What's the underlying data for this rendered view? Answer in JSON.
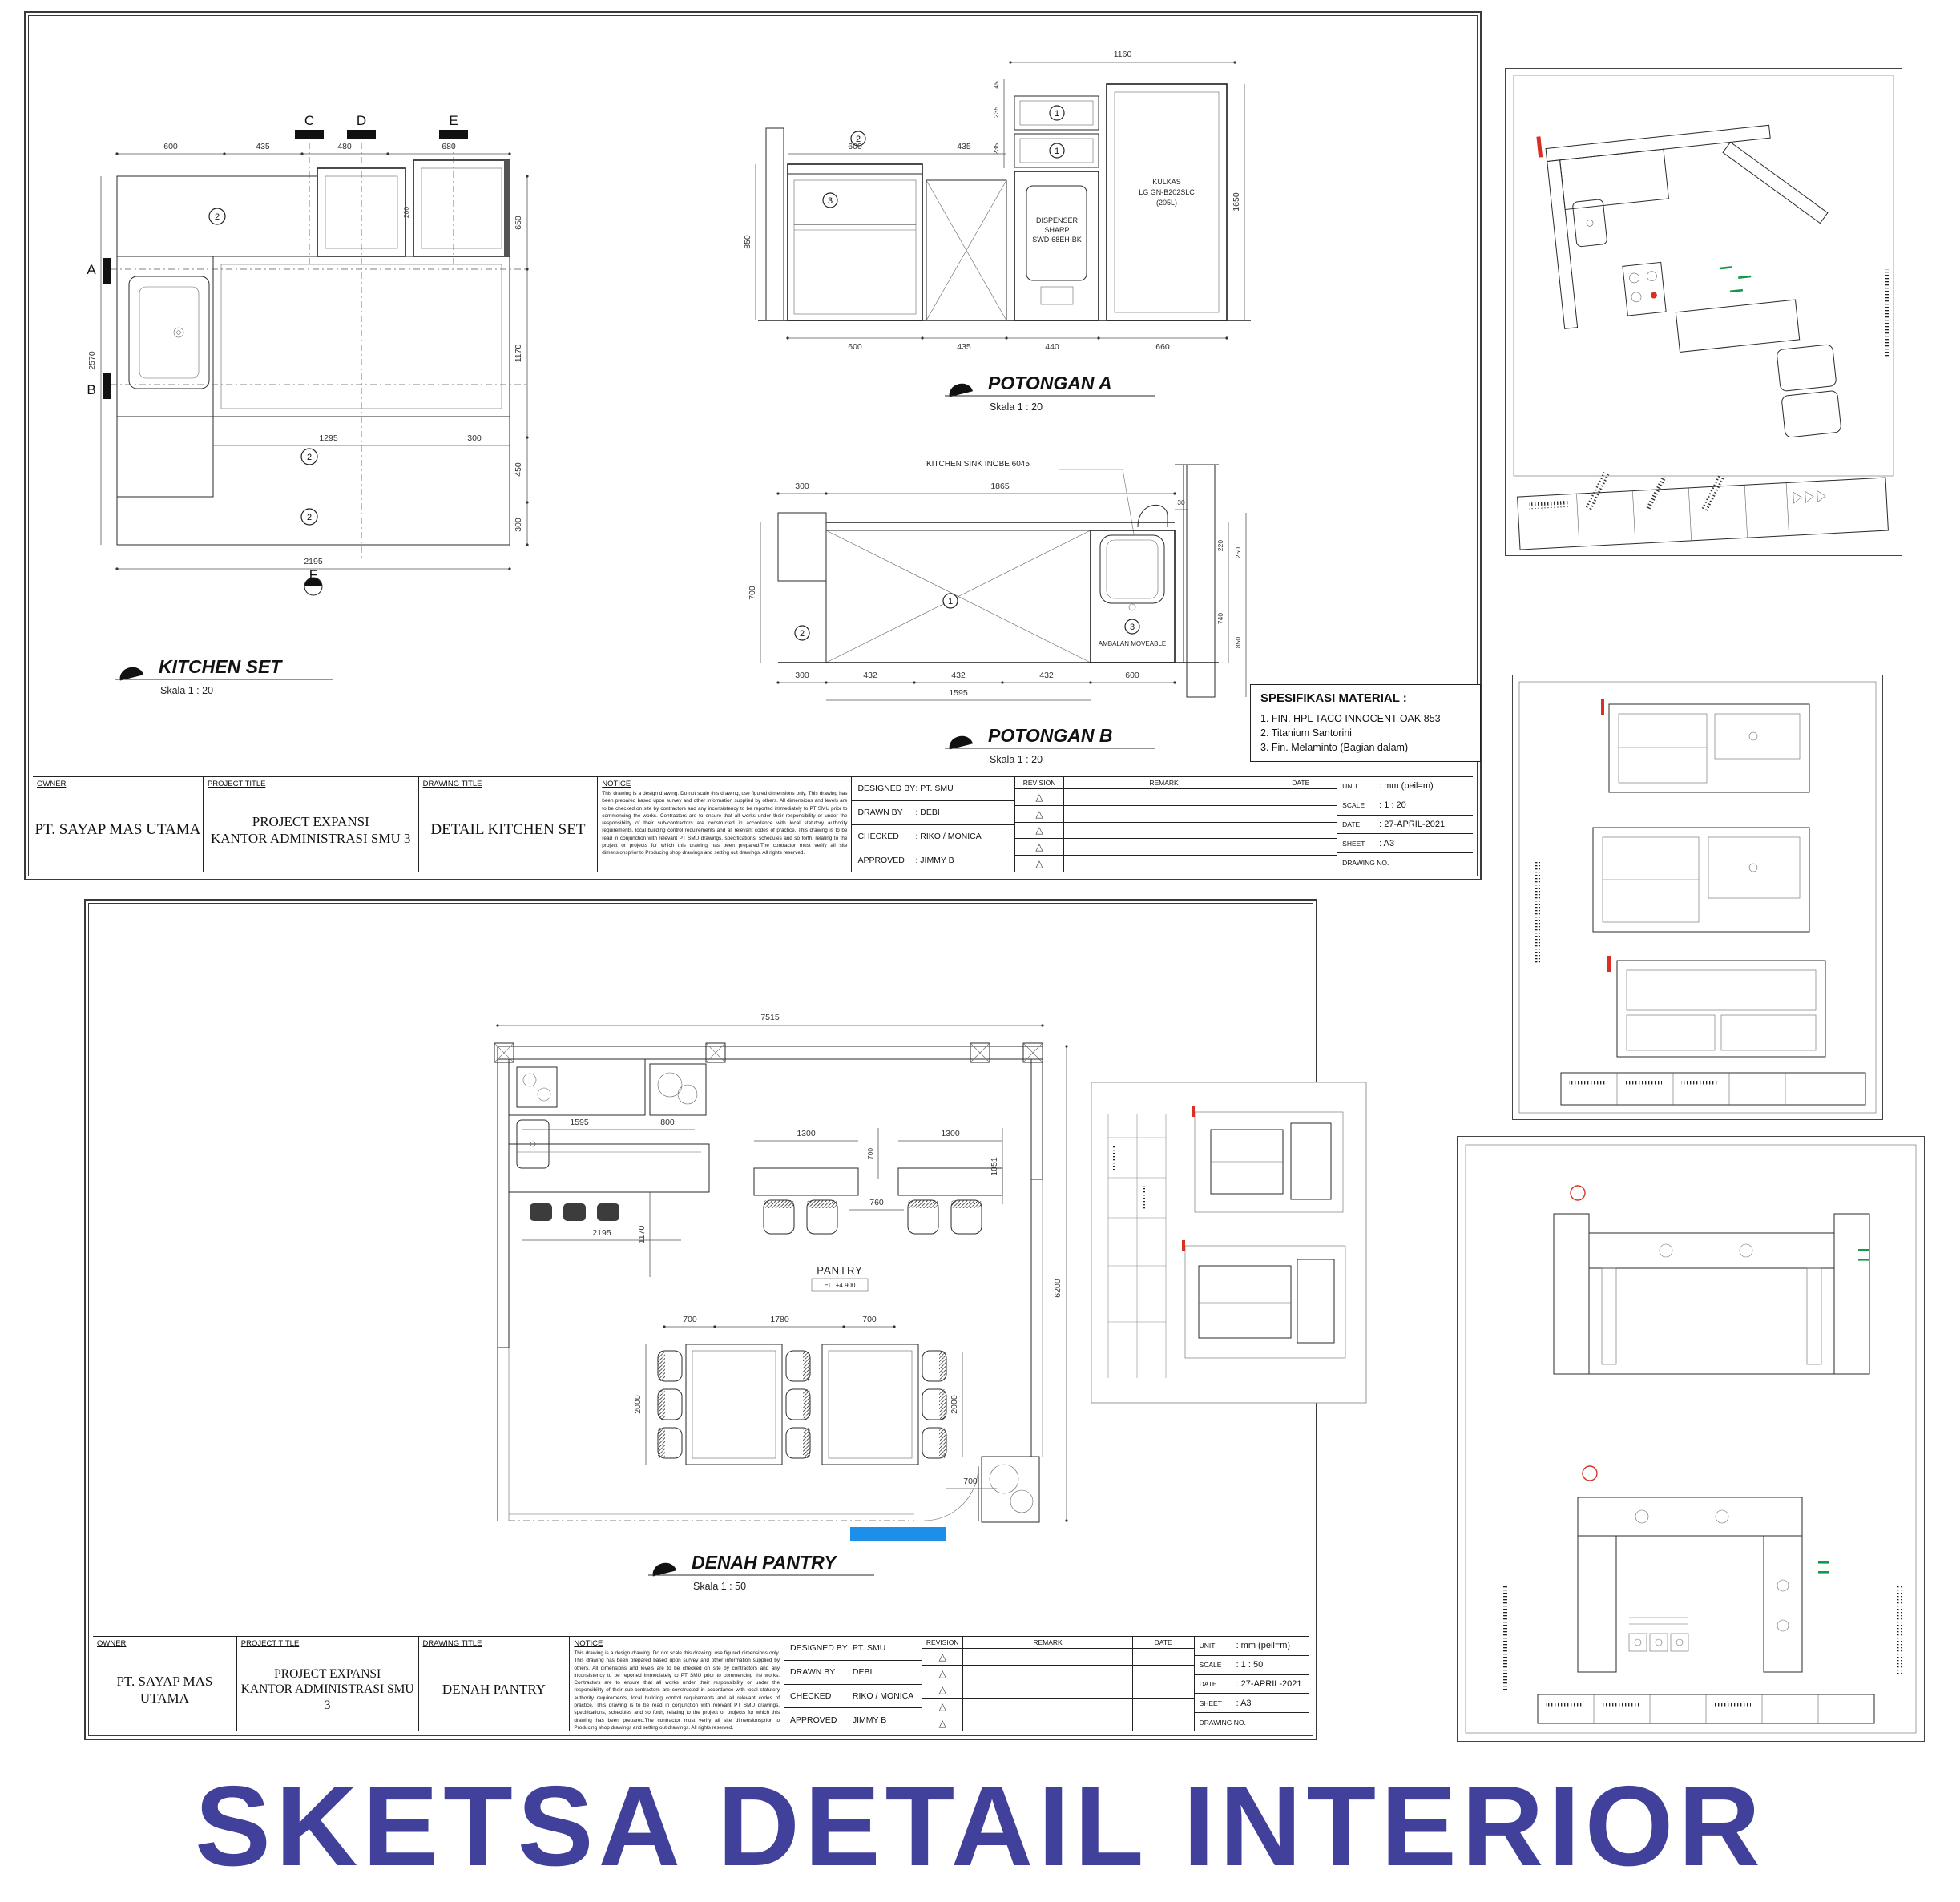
{
  "page_title": "SKETSA DETAIL INTERIOR",
  "colors": {
    "title_blue": "#41419B",
    "mark_red": "#D93025",
    "mark_green": "#12994B",
    "highlight_blue": "#1E8FE8"
  },
  "tb_labels": {
    "owner": "OWNER",
    "project_title": "PROJECT TITLE",
    "drawing_title": "DRAWING TITLE",
    "notice": "NOTICE",
    "designed_by": "DESIGNED BY",
    "drawn_by": "DRAWN BY",
    "checked": "CHECKED",
    "approved": "APPROVED",
    "revision": "REVISION",
    "remark": "REMARK",
    "date": "DATE",
    "unit": "UNIT",
    "scale": "SCALE",
    "sheet": "SHEET",
    "drawing_no": "DRAWING NO.",
    "revision_triangle": "△"
  },
  "sheet1": {
    "titleblock": {
      "owner": "PT. SAYAP MAS UTAMA",
      "project_line1": "PROJECT EXPANSI",
      "project_line2": "KANTOR ADMINISTRASI SMU 3",
      "drawing": "DETAIL KITCHEN SET",
      "notice_text": "This drawing is a design drawing. Do not scale this drawing, use figured dimensions only. This drawing has been prepared based upon survey and other information supplied by others. All dimensions and levels are to be checked on site by contractors and any inconsistency to be reported immediately to PT SMU prior to commencing the works. Contractors are to ensure that all works under their responsibility or under the responsibility of their sub-contractors are constructed in accordance with local statutory authority requirements, local building control requirements and all relevant codes of practice. This drawing is to be read in conjunction with relevant PT SMU drawings, specifications, schedules and so forth, relating to the project or projects for which this drawing has been prepared.The contractor must verify all site dimensionsprior to Producing shop drawings and setting out drawings. All rights reserved.",
      "designed": ": PT. SMU",
      "drawn": ": DEBI",
      "checked": ": RIKO / MONICA",
      "approved": ": JIMMY B",
      "unit": ": mm (peil=m)",
      "scale": ": 1 : 20",
      "date": ": 27-APRIL-2021",
      "sheet": ": A3"
    },
    "spesifikasi": {
      "title": "SPESIFIKASI MATERIAL :",
      "items": [
        "1. FIN. HPL TACO INNOCENT OAK 853",
        "2. Titanium Santorini",
        "3. Fin. Melaminto (Bagian dalam)"
      ]
    },
    "kitchen_set": {
      "title": "KITCHEN SET",
      "scale": "Skala 1 : 20",
      "callout": "2",
      "sections": [
        "C",
        "D",
        "E",
        "A",
        "B",
        "F"
      ],
      "dims": {
        "top": [
          "600",
          "435",
          "480",
          "680"
        ],
        "left": [
          "2570"
        ],
        "right": [
          "650",
          "1170",
          "450",
          "300"
        ],
        "small": "200",
        "bottom": [
          "1295",
          "300",
          "2195"
        ]
      }
    },
    "potongan_a": {
      "title": "POTONGAN A",
      "scale": "Skala 1 : 20",
      "dispenser": [
        "DISPENSER",
        "SHARP",
        "SWD-68EH-BK"
      ],
      "kulkas": [
        "KULKAS",
        "LG GN-B202SLC",
        "(205L)"
      ],
      "callouts": [
        "1",
        "1",
        "2",
        "3"
      ],
      "dims": {
        "top": [
          "1160"
        ],
        "inner_top": [
          "600",
          "435"
        ],
        "left": [
          "850"
        ],
        "left_upper": [
          "45",
          "235",
          "235"
        ],
        "right": [
          "1650"
        ],
        "bottom": [
          "600",
          "435",
          "440",
          "660"
        ]
      }
    },
    "potongan_b": {
      "title": "POTONGAN B",
      "scale": "Skala 1 : 20",
      "sink_label": "KITCHEN SINK INOBE 6045",
      "shelf_label": "AMBALAN MOVEABLE",
      "callouts": [
        "2",
        "1",
        "3"
      ],
      "dims": {
        "top": [
          "300",
          "1865",
          "30"
        ],
        "left": [
          "700"
        ],
        "right": [
          "220",
          "250",
          "740",
          "850"
        ],
        "bottom": [
          "300",
          "432",
          "432",
          "432"
        ],
        "bottom2": [
          "1595",
          "600"
        ]
      }
    }
  },
  "sheet2": {
    "titleblock": {
      "owner": "PT. SAYAP MAS UTAMA",
      "project_line1": "PROJECT EXPANSI",
      "project_line2": "KANTOR ADMINISTRASI SMU 3",
      "drawing": "DENAH PANTRY",
      "notice_text": "This drawing is a design drawing. Do not scale this drawing, use figured dimensions only. This drawing has been prepared based upon survey and other information supplied by others. All dimensions and levels are to be checked on site by contractors and any inconsistency to be reported immediately to PT SMU prior to commencing the works. Contractors are to ensure that all works under their responsibility or under the responsibility of their sub-contractors are constructed in accordance with local statutory authority requirements, local building control requirements and all relevant codes of practice. This drawing is to be read in conjunction with relevant PT SMU drawings, specifications, schedules and so forth, relating to the project or projects for which this drawing has been prepared.The contractor must verify all site dimensionsprior to Producing shop drawings and setting out drawings. All rights reserved.",
      "designed": ": PT. SMU",
      "drawn": ": DEBI",
      "checked": ": RIKO / MONICA",
      "approved": ": JIMMY B",
      "unit": ": mm (peil=m)",
      "scale": ": 1 : 50",
      "date": ": 27-APRIL-2021",
      "sheet": ": A3"
    },
    "denah_pantry": {
      "title": "DENAH PANTRY",
      "scale": "Skala 1 : 50",
      "room_label": "PANTRY",
      "room_level": "EL. +4.900",
      "dims": {
        "top": [
          "7515"
        ],
        "row1": [
          "1595",
          "800",
          "1300",
          "700",
          "1300",
          "760"
        ],
        "row2": [
          "2195",
          "700",
          "1780",
          "700"
        ],
        "vert": [
          "1170",
          "1051",
          "2000",
          "2000",
          "700",
          "6200"
        ]
      }
    }
  }
}
